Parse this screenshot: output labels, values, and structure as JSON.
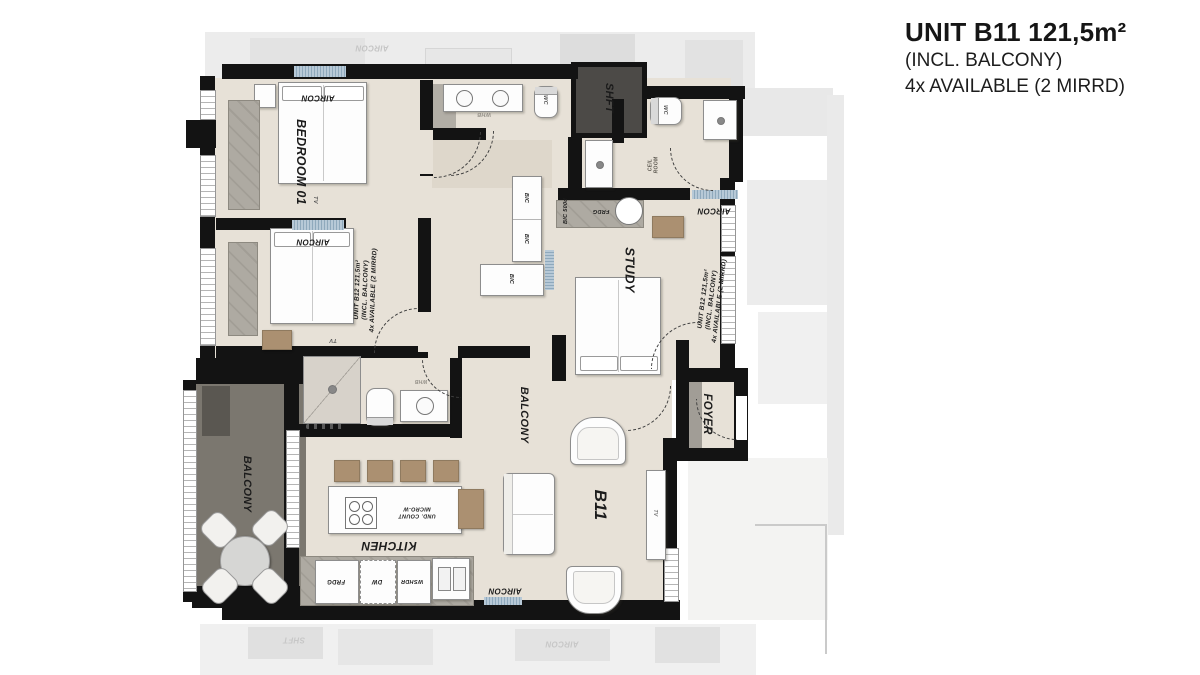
{
  "header": {
    "title": "UNIT B11  121,5m²",
    "subtitle": "(INCL. BALCONY)",
    "availability": "4x AVAILABLE (2 MIRRD)"
  },
  "rooms": {
    "bedroom01": "BEDROOM 01",
    "study": "STUDY",
    "foyer": "FOYER",
    "balcony": "BALCONY",
    "kitchen": "KITCHEN",
    "living": "B11",
    "shaft": "SHFT"
  },
  "fixtures": {
    "aircon": "AIRCON",
    "tv": "TV",
    "whb": "WHB",
    "wc": "WC",
    "bic": "BIC",
    "bic_500d": "BIC 500d",
    "frdg": "FRDG",
    "dw": "DW",
    "wshdr": "WSHDR",
    "micro_l1": "UND. COUNT",
    "micro_l2": "MICRO-W",
    "ceil_l1": "CEIL",
    "ceil_l2": "ROOM"
  },
  "neighbor": {
    "l1": "UNIT B12  121,5m²",
    "l2": "(INCL. BALCONY)",
    "l3": "4x AVAILABLE (2 MIRRD)"
  },
  "ghost": {
    "shft": "SHFT",
    "aircon": "AIRCON"
  },
  "colors": {
    "wall": "#131313",
    "floor": "#e7e1d7",
    "balcony_floor": "#7b776f",
    "shaft": "#4c4a47",
    "cabinet": "#aeaaa2",
    "aircon_hatch": "#8fa9bc",
    "wood": "#ab9071",
    "ghost": "#ececec"
  }
}
